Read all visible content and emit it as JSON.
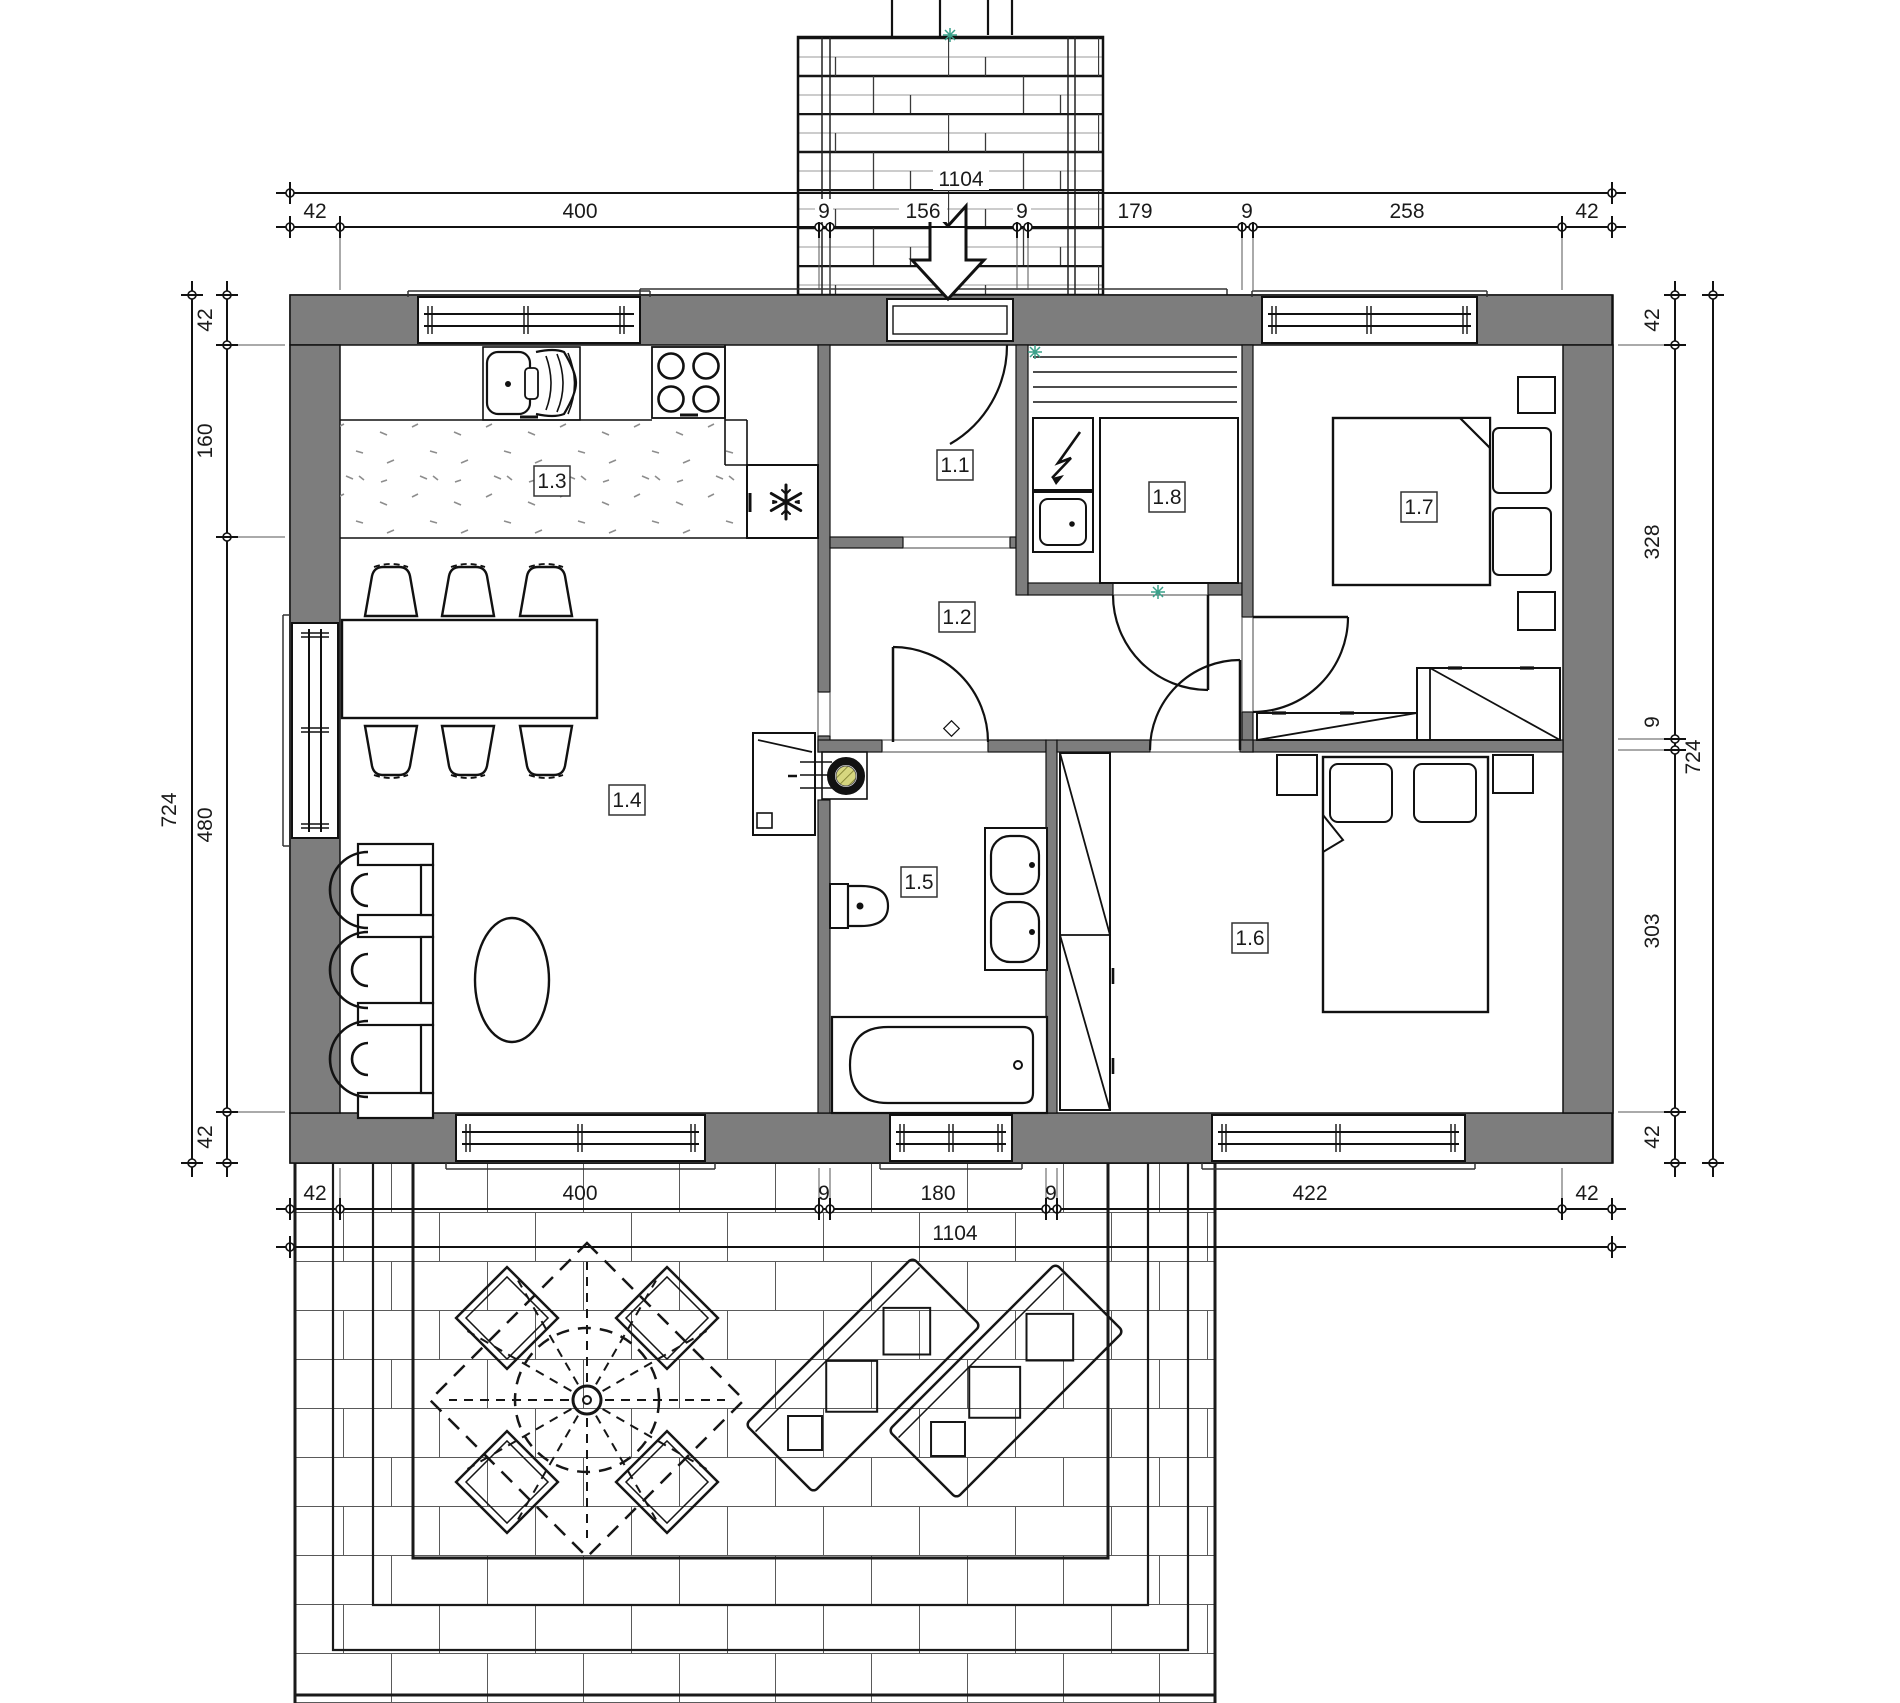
{
  "drawing": {
    "room_labels": {
      "r11": "1.1",
      "r12": "1.2",
      "r13": "1.3",
      "r14": "1.4",
      "r15": "1.5",
      "r16": "1.6",
      "r17": "1.7",
      "r18": "1.8"
    },
    "dimensions": {
      "top": {
        "total": "1104",
        "segments": [
          "42",
          "400",
          "9",
          "156",
          "9",
          "179",
          "9",
          "258",
          "42"
        ]
      },
      "bottom": {
        "total": "1104",
        "segments": [
          "42",
          "400",
          "9",
          "180",
          "9",
          "422",
          "42"
        ]
      },
      "left": {
        "total": "724",
        "segments": [
          "42",
          "160",
          "480",
          "42"
        ]
      },
      "right": {
        "total": "724",
        "segments": [
          "42",
          "328",
          "9",
          "303",
          "42"
        ]
      }
    },
    "colors": {
      "wall_fill": "#7d7d7d",
      "line": "#1a1a1a",
      "marker_green": "#3aa08a",
      "boiler_core": "#d6d67f"
    }
  }
}
